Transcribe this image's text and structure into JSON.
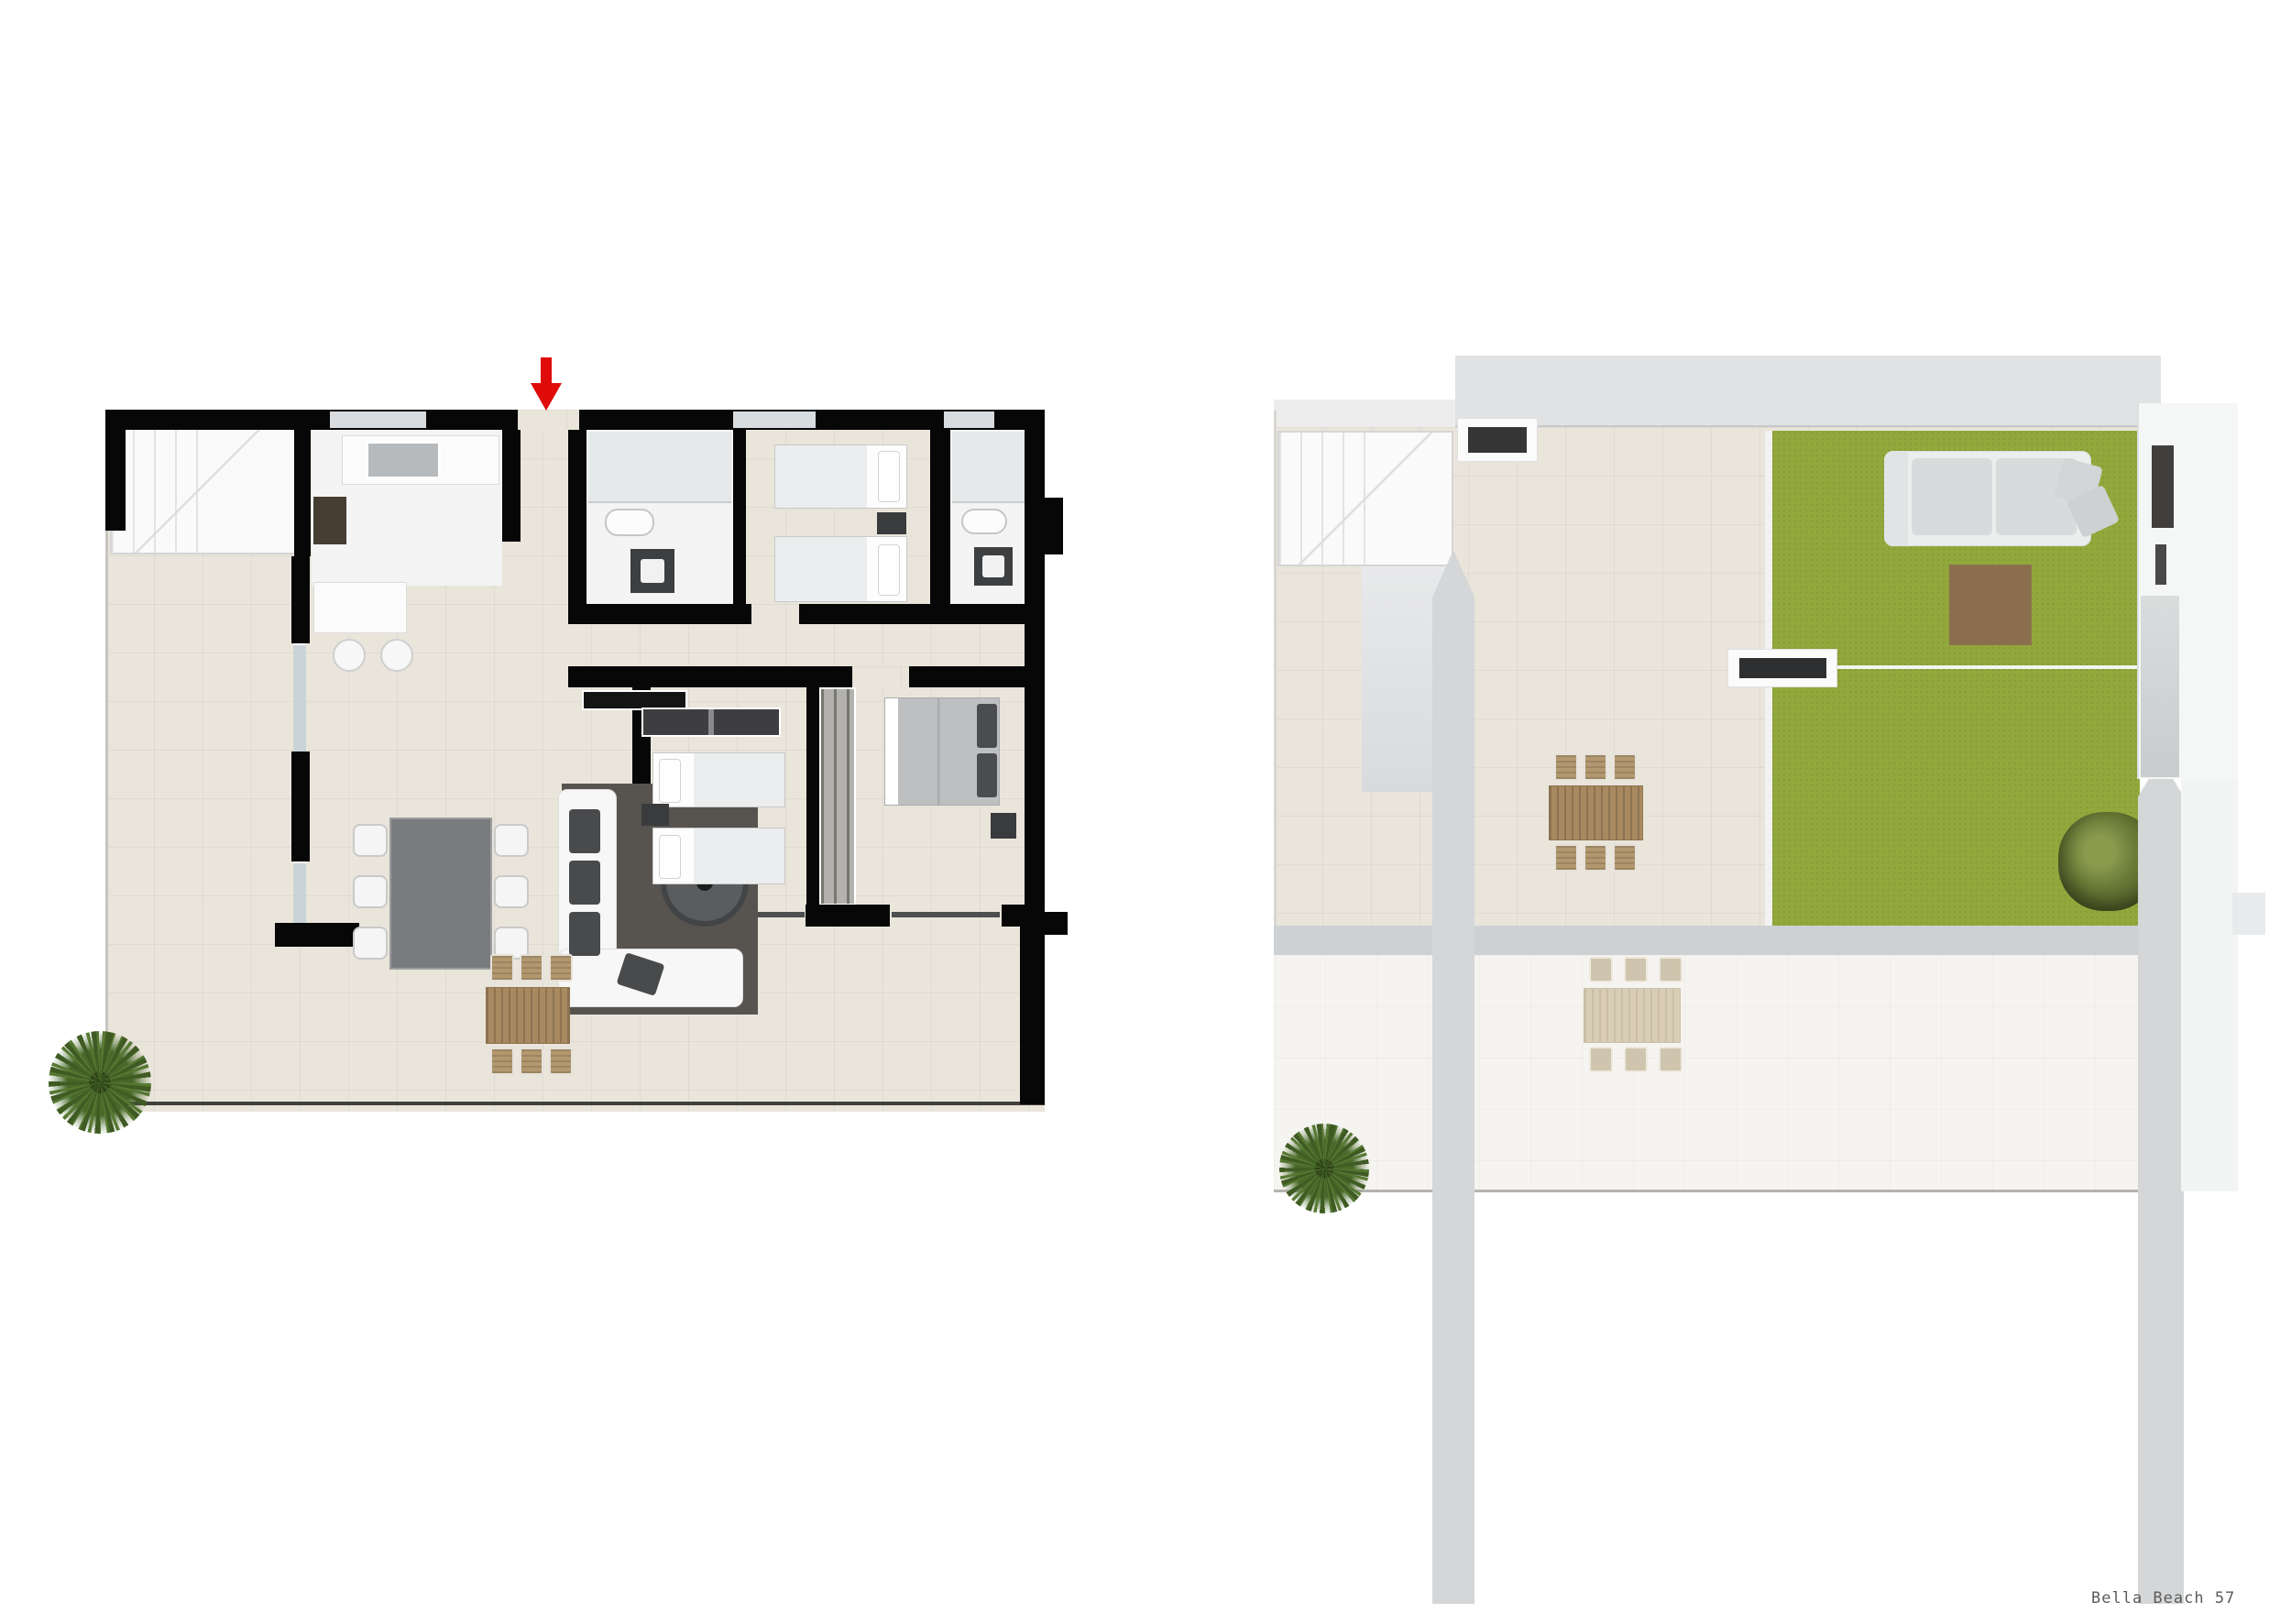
{
  "caption": {
    "text": "Bella Beach 57"
  },
  "entrance": {
    "indicator": "red-arrow-down"
  },
  "colors": {
    "page-bg": "#ffffff",
    "wall": "#070707",
    "tile": "#eae5db",
    "room-white": "#f3f4f3",
    "window-slab": "#d9dcde",
    "glass": "#c9d4d6",
    "stairs": "#fafafa",
    "rug": "#575450",
    "sofa": "#f7f7f7",
    "cushion": "#494a4c",
    "dining-table": "#797b7c",
    "chair-white": "#f5f5f5",
    "wood": "#a98a60",
    "wood-slat": "#8d7350",
    "ghost-wood": "#d9cdb7",
    "ghost-wood-slat": "#cabfa7",
    "bed-white": "#fdfdfd",
    "blanket": "#ebedee",
    "master-duvet": "#bdbfc1",
    "dark-furniture": "#3a3b3c",
    "grass": "#93a83c",
    "roof": "#e0e2e4",
    "pillar": "#d4d6d8",
    "walkway": "#ced1d3",
    "lower-terrace": "#f6f4f0",
    "column-white": "#f5f6f6",
    "arrow-red": "#e00b0b",
    "caption-gray": "#5c5c5c"
  },
  "plans": {
    "left": {
      "name": "interior-floor-plan",
      "rooms": [
        "staircase",
        "kitchen",
        "hallway",
        "bathroom-1",
        "twin-bedroom",
        "bathroom-2",
        "living-dining",
        "second-twin-bedroom",
        "master-bedroom",
        "terrace"
      ]
    },
    "right": {
      "name": "solarium-roof-plan",
      "rooms": [
        "staircase",
        "roof-band",
        "lawn",
        "terrace",
        "lower-terrace"
      ]
    }
  }
}
